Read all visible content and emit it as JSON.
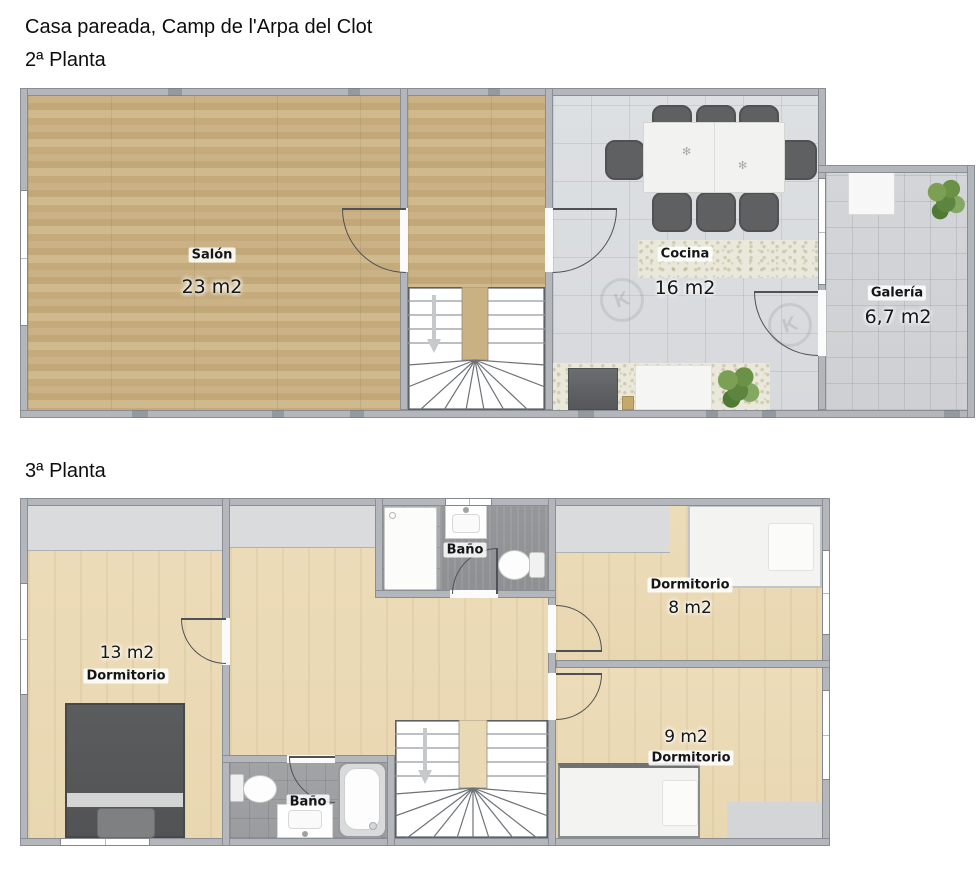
{
  "title": "Casa pareada, Camp de l'Arpa del Clot",
  "floors": [
    {
      "label": "2ª Planta",
      "rooms": [
        {
          "name": "Salón",
          "area": "23 m2"
        },
        {
          "name": "Cocina",
          "area": "16 m2"
        },
        {
          "name": "Galería",
          "area": "6,7 m2"
        }
      ]
    },
    {
      "label": "3ª Planta",
      "rooms": [
        {
          "name": "Dormitorio",
          "area": "13 m2"
        },
        {
          "name": "Baño"
        },
        {
          "name": "Dormitorio",
          "area": "8 m2"
        },
        {
          "name": "Dormitorio",
          "area": "9 m2"
        },
        {
          "name": "Baño"
        }
      ]
    }
  ],
  "watermark_letter": "K",
  "colors": {
    "wood_floor2": "#c7ae81",
    "wood_floor3": "#ecdcb8",
    "tile_kitchen": "#dcdee1",
    "tile_gallery": "#d3d5d8",
    "tile_bath": "#a5a7a9",
    "wall": "#b3b7bc"
  }
}
